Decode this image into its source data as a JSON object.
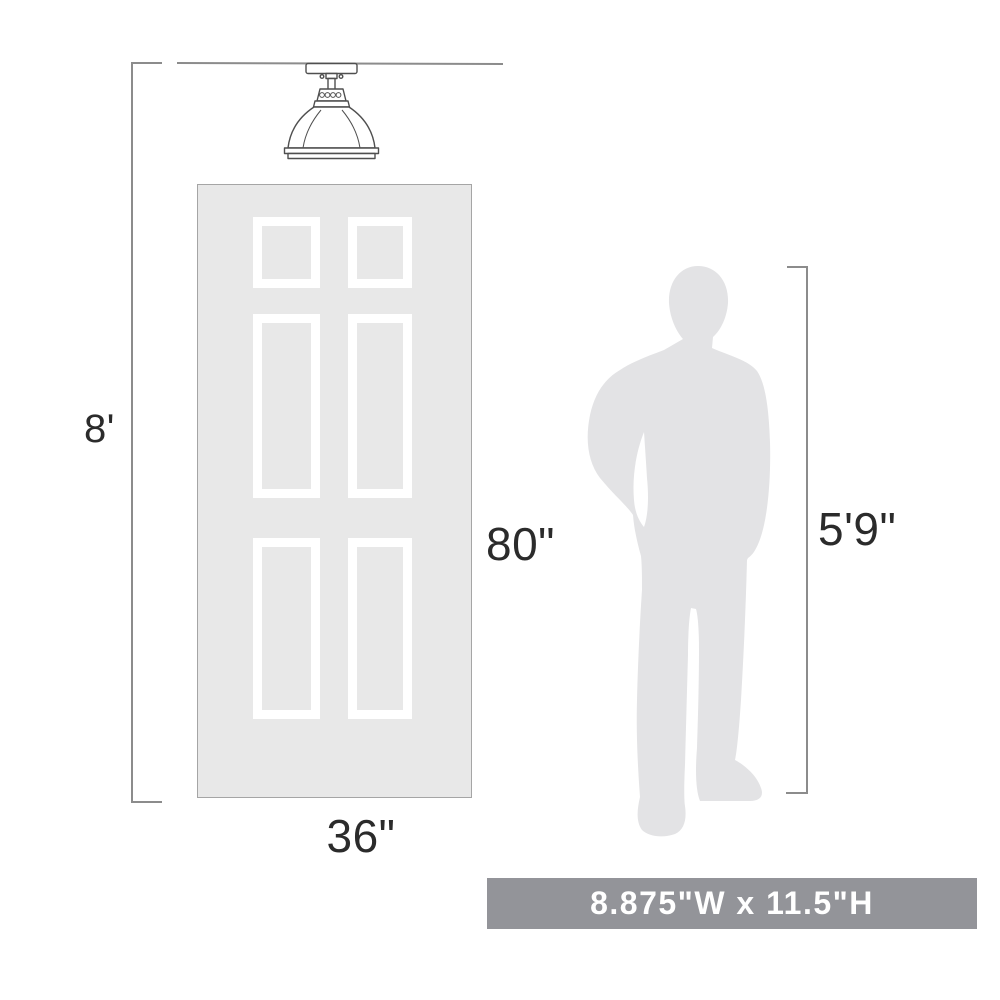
{
  "diagram": {
    "title_semantics": "product-size-comparison-diagram",
    "labels": {
      "ceiling_height": "8'",
      "door_height": "80\"",
      "door_width": "36\"",
      "person_height": "5'9\""
    },
    "banner": {
      "text": "8.875\"W x 11.5\"H"
    },
    "graphics": {
      "fixture": "semi-flush-mount-dome-light-drawing",
      "door": "six-panel-door",
      "person": "standing-man-silhouette"
    },
    "colors": {
      "background": "#ffffff",
      "door_fill": "#e8e8e8",
      "door_border": "#a5a5a5",
      "panel_frame": "#ffffff",
      "person_fill": "#e3e3e5",
      "dimension_line": "#8c8c8c",
      "fixture_stroke": "#4f4f4f",
      "label_text": "#2b2b2b",
      "banner_bg": "#939499",
      "banner_text": "#ffffff"
    }
  }
}
